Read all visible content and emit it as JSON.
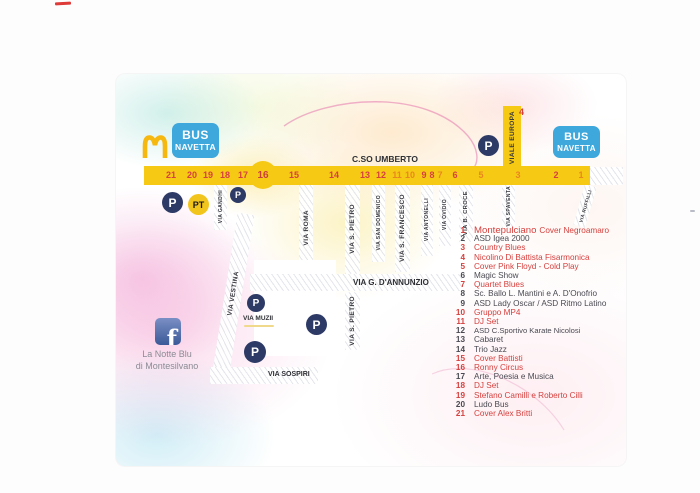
{
  "branding": {
    "event_line1": "La Notte Blu",
    "event_line2": "di Montesilvano",
    "facebook_glyph": "f",
    "mcdonalds_color": "#F6B70E"
  },
  "shuttle": {
    "line1": "BUS",
    "line2": "NAVETTA",
    "box_color": "#3EA7DC"
  },
  "icons": {
    "parking": "P",
    "parking_bus": "PT"
  },
  "palette": {
    "road_yellow": "#F6C914",
    "stop_red": "#D6403E",
    "stop_orange": "#E8871E",
    "legend_dark": "#4A4A52",
    "marker_blue": "#2E3A66",
    "bus_blue": "#3EA7DC"
  },
  "map": {
    "main_road": {
      "name": "C.SO UMBERTO"
    },
    "viale_europa": {
      "name": "VIALE EUROPA",
      "stop": "4"
    },
    "hub_stop": "16",
    "stops": [
      {
        "n": "21",
        "tone": "red"
      },
      {
        "n": "20",
        "tone": "red"
      },
      {
        "n": "19",
        "tone": "red"
      },
      {
        "n": "18",
        "tone": "red"
      },
      {
        "n": "17",
        "tone": "red"
      },
      {
        "n": "15",
        "tone": "red"
      },
      {
        "n": "14",
        "tone": "red"
      },
      {
        "n": "13",
        "tone": "red"
      },
      {
        "n": "12",
        "tone": "red"
      },
      {
        "n": "11",
        "tone": "orange"
      },
      {
        "n": "10",
        "tone": "orange"
      },
      {
        "n": "9",
        "tone": "red"
      },
      {
        "n": "8",
        "tone": "red"
      },
      {
        "n": "7",
        "tone": "orange"
      },
      {
        "n": "6",
        "tone": "red"
      },
      {
        "n": "5",
        "tone": "orange"
      },
      {
        "n": "3",
        "tone": "orange"
      },
      {
        "n": "2",
        "tone": "red"
      },
      {
        "n": "1",
        "tone": "orange"
      }
    ],
    "streets": {
      "gandhi": "VIA GANDHI",
      "vestina": "VIA VESTINA",
      "roma": "VIA ROMA",
      "pietro_nord": "VIA S. PIETRO",
      "domenico": "VIA SAN DOMENICO",
      "francesco": "VIA S. FRANCESCO",
      "antonelli": "VIA ANTONELLI",
      "ovidio": "VIA OVIDIO",
      "bcroce": "VIA B. CROCE",
      "spaventa": "VIA SPAVENTA",
      "ruffilli": "VIA RUFFILLI",
      "dannunzio": "VIA G. D'ANNUNZIO",
      "muzii": "VIA MUZII",
      "pietro_sud": "VIA S. PIETRO",
      "sospiri": "VIA SOSPIRI"
    }
  },
  "legend": {
    "items": [
      {
        "num": "1",
        "text": "Montepulciano",
        "suffix": "Cover Negroamaro",
        "tone": "red"
      },
      {
        "num": "2",
        "text": "ASD Igea 2000",
        "tone": "dark"
      },
      {
        "num": "3",
        "text": "Country Blues",
        "tone": "red"
      },
      {
        "num": "4",
        "text": "Nicolino Di Battista Fisarmonica",
        "tone": "red"
      },
      {
        "num": "5",
        "text": "Cover Pink Floyd - Cold Play",
        "tone": "red"
      },
      {
        "num": "6",
        "text": "Magic Show",
        "tone": "dark"
      },
      {
        "num": "7",
        "text": "Quartet Blues",
        "tone": "red"
      },
      {
        "num": "8",
        "text": "Sc. Ballo L. Mantini e A. D'Onofrio",
        "tone": "dark"
      },
      {
        "num": "9",
        "text": "ASD Lady Oscar / ASD Ritmo Latino",
        "tone": "dark"
      },
      {
        "num": "10",
        "text": "Gruppo MP4",
        "tone": "red"
      },
      {
        "num": "11",
        "text": "DJ Set",
        "tone": "red"
      },
      {
        "num": "12",
        "text": "ASD C.Sportivo Karate Nicolosi",
        "tone": "dark"
      },
      {
        "num": "13",
        "text": "Cabaret",
        "tone": "dark"
      },
      {
        "num": "14",
        "text": "Trio Jazz",
        "tone": "dark"
      },
      {
        "num": "15",
        "text": "Cover Battisti",
        "tone": "red"
      },
      {
        "num": "16",
        "text": "Ronny Circus",
        "tone": "red"
      },
      {
        "num": "17",
        "text": "Arte, Poesia e Musica",
        "tone": "dark"
      },
      {
        "num": "18",
        "text": "DJ Set",
        "tone": "red"
      },
      {
        "num": "19",
        "text": "Stefano Camilli e Roberto Cilli",
        "tone": "red"
      },
      {
        "num": "20",
        "text": "Ludo Bus",
        "tone": "dark"
      },
      {
        "num": "21",
        "text": "Cover Alex Britti",
        "tone": "red"
      }
    ]
  }
}
